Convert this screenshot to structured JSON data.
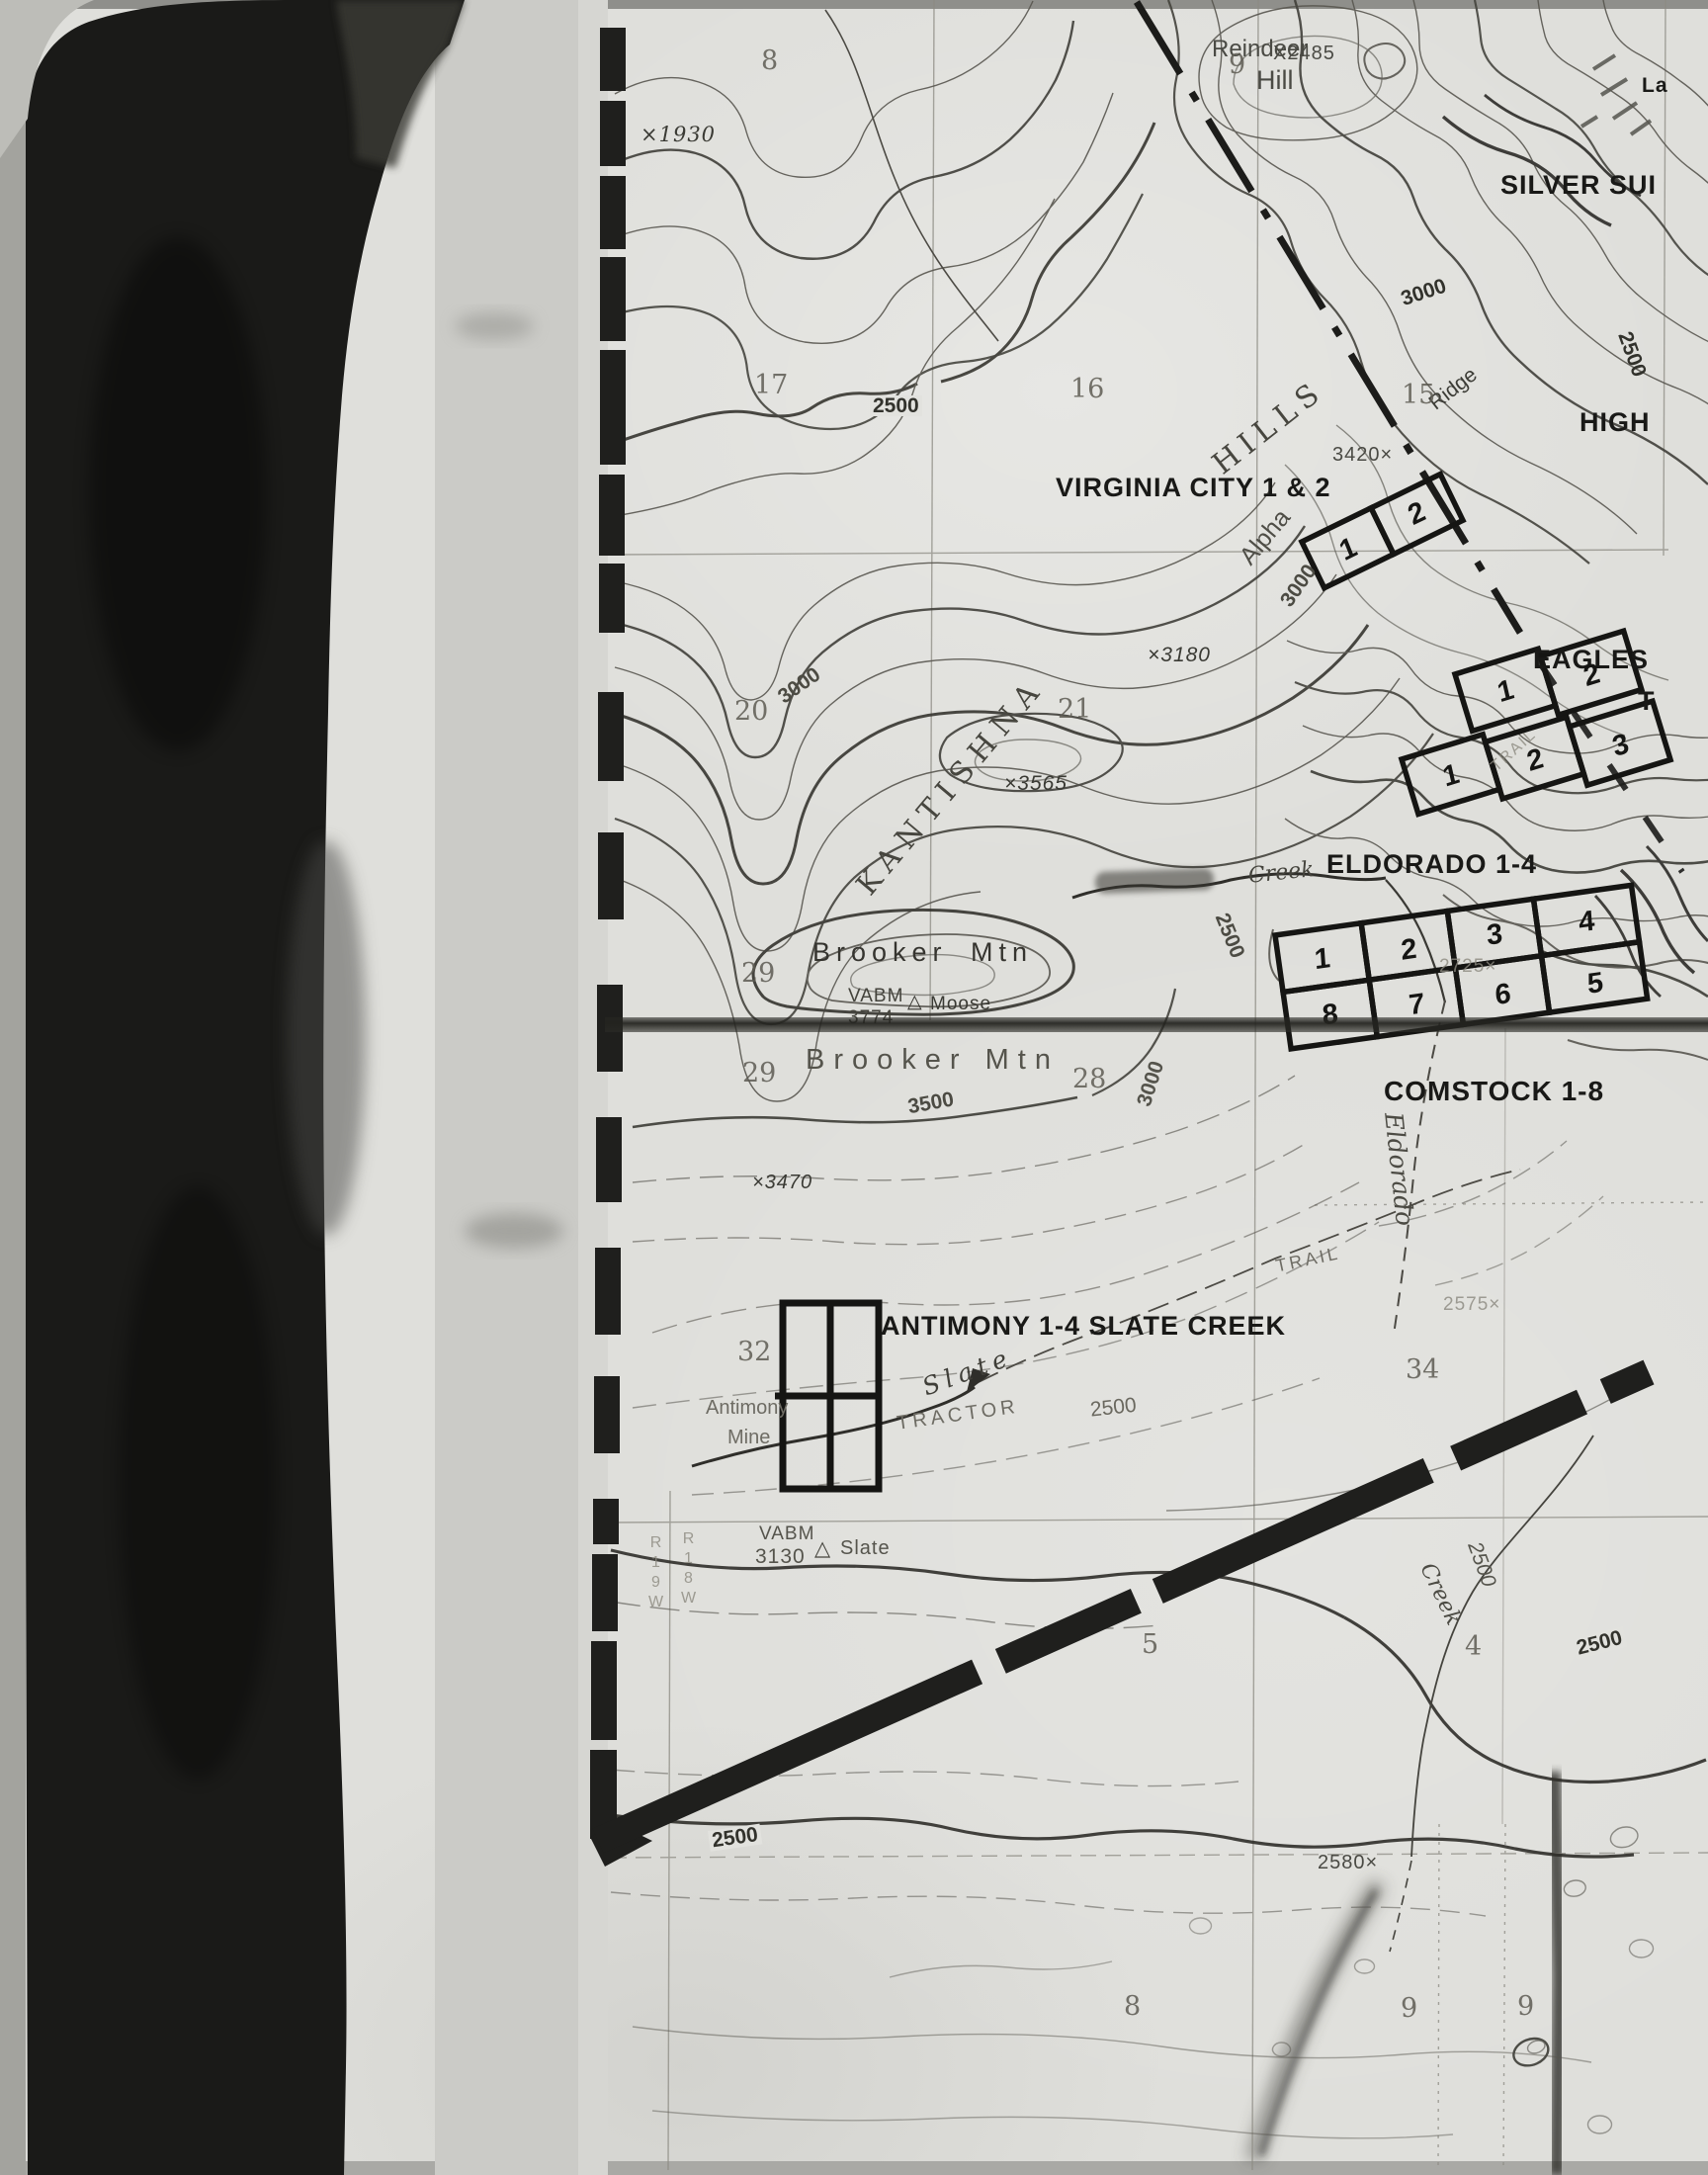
{
  "title": "Kantishna Hills mining claims topographic map scan",
  "claim_labels": {
    "silver": "SILVER SUI",
    "high": "HIGH",
    "la": "La",
    "virginia_city": "VIRGINIA CITY 1 & 2",
    "eagles": "EAGLES",
    "eagles_t": "T",
    "eldorado": "ELDORADO 1-4",
    "comstock": "COMSTOCK 1-8",
    "antimony": "ANTIMONY 1-4 SLATE CREEK"
  },
  "claim_numbers": {
    "virginia": [
      "1",
      "2"
    ],
    "eagles": [
      "1",
      "2"
    ],
    "eldorado": [
      "1",
      "2",
      "3"
    ],
    "comstock_top": [
      "1",
      "2",
      "3",
      "4"
    ],
    "comstock_bottom": [
      "8",
      "7",
      "6",
      "5"
    ]
  },
  "features": {
    "reindeer": "Reindeer",
    "hill": "Hill",
    "kantishna": "KANTISHNA",
    "hills": "HILLS",
    "ridge": "Ridge",
    "alpha": "Alpha",
    "brooker_a": "Brooker",
    "brooker_b": "Mtn",
    "brooker2": "Brooker Mtn",
    "eldorado_creek": "Eldorado",
    "creek_mid": "Creek",
    "creek_right": "Creek",
    "slate_creek": "Slate",
    "tractor": "TRACTOR",
    "trail": "TRAIL",
    "trail2": "TRAIL",
    "antimony_mine_1": "Antimony",
    "antimony_mine_2": "Mine"
  },
  "benchmarks": {
    "vabm1": "VABM",
    "vabm1_elev": "3774",
    "moose_tri": "△",
    "moose": "Moose",
    "vabm2": "VABM",
    "vabm2_elev": "3130",
    "slate_tri": "△",
    "slate_bm": "Slate"
  },
  "elevations": {
    "e1930": "×1930",
    "e2485": "X2485",
    "e3420": "3420×",
    "e3180": "×3180",
    "e3565": "×3565",
    "e3470": "×3470",
    "e2725": "2725×",
    "e2575": "2575×",
    "e2580": "2580×"
  },
  "contour_labels": {
    "top": "2500",
    "right_edge": "2500",
    "ne_slope": "3000",
    "central": "3000",
    "alpha_box": "3000",
    "brooker": "3000",
    "south": "3500",
    "slate": "2500",
    "comstock_w": "2500",
    "creek_r": "2500",
    "four": "2500",
    "bottom": "2500"
  },
  "sections": {
    "s8": "8",
    "s9": "9",
    "s15": "15",
    "s16": "16",
    "s17": "17",
    "s20": "20",
    "s21": "21",
    "s28": "28",
    "s29a": "29",
    "s29b": "29",
    "s32": "32",
    "s34": "34",
    "s5": "5",
    "s4": "4",
    "s8b": "8",
    "s9b": "9",
    "s9c": "9"
  },
  "range_ticks": {
    "left": "R19W",
    "right": "R18W"
  },
  "colors": {
    "paper": "#dfdfdb",
    "contour_ink": "#57554e",
    "heavy_ink": "#2b2a26",
    "claim_ink": "#151513",
    "scan_black": "#1a1a18"
  }
}
